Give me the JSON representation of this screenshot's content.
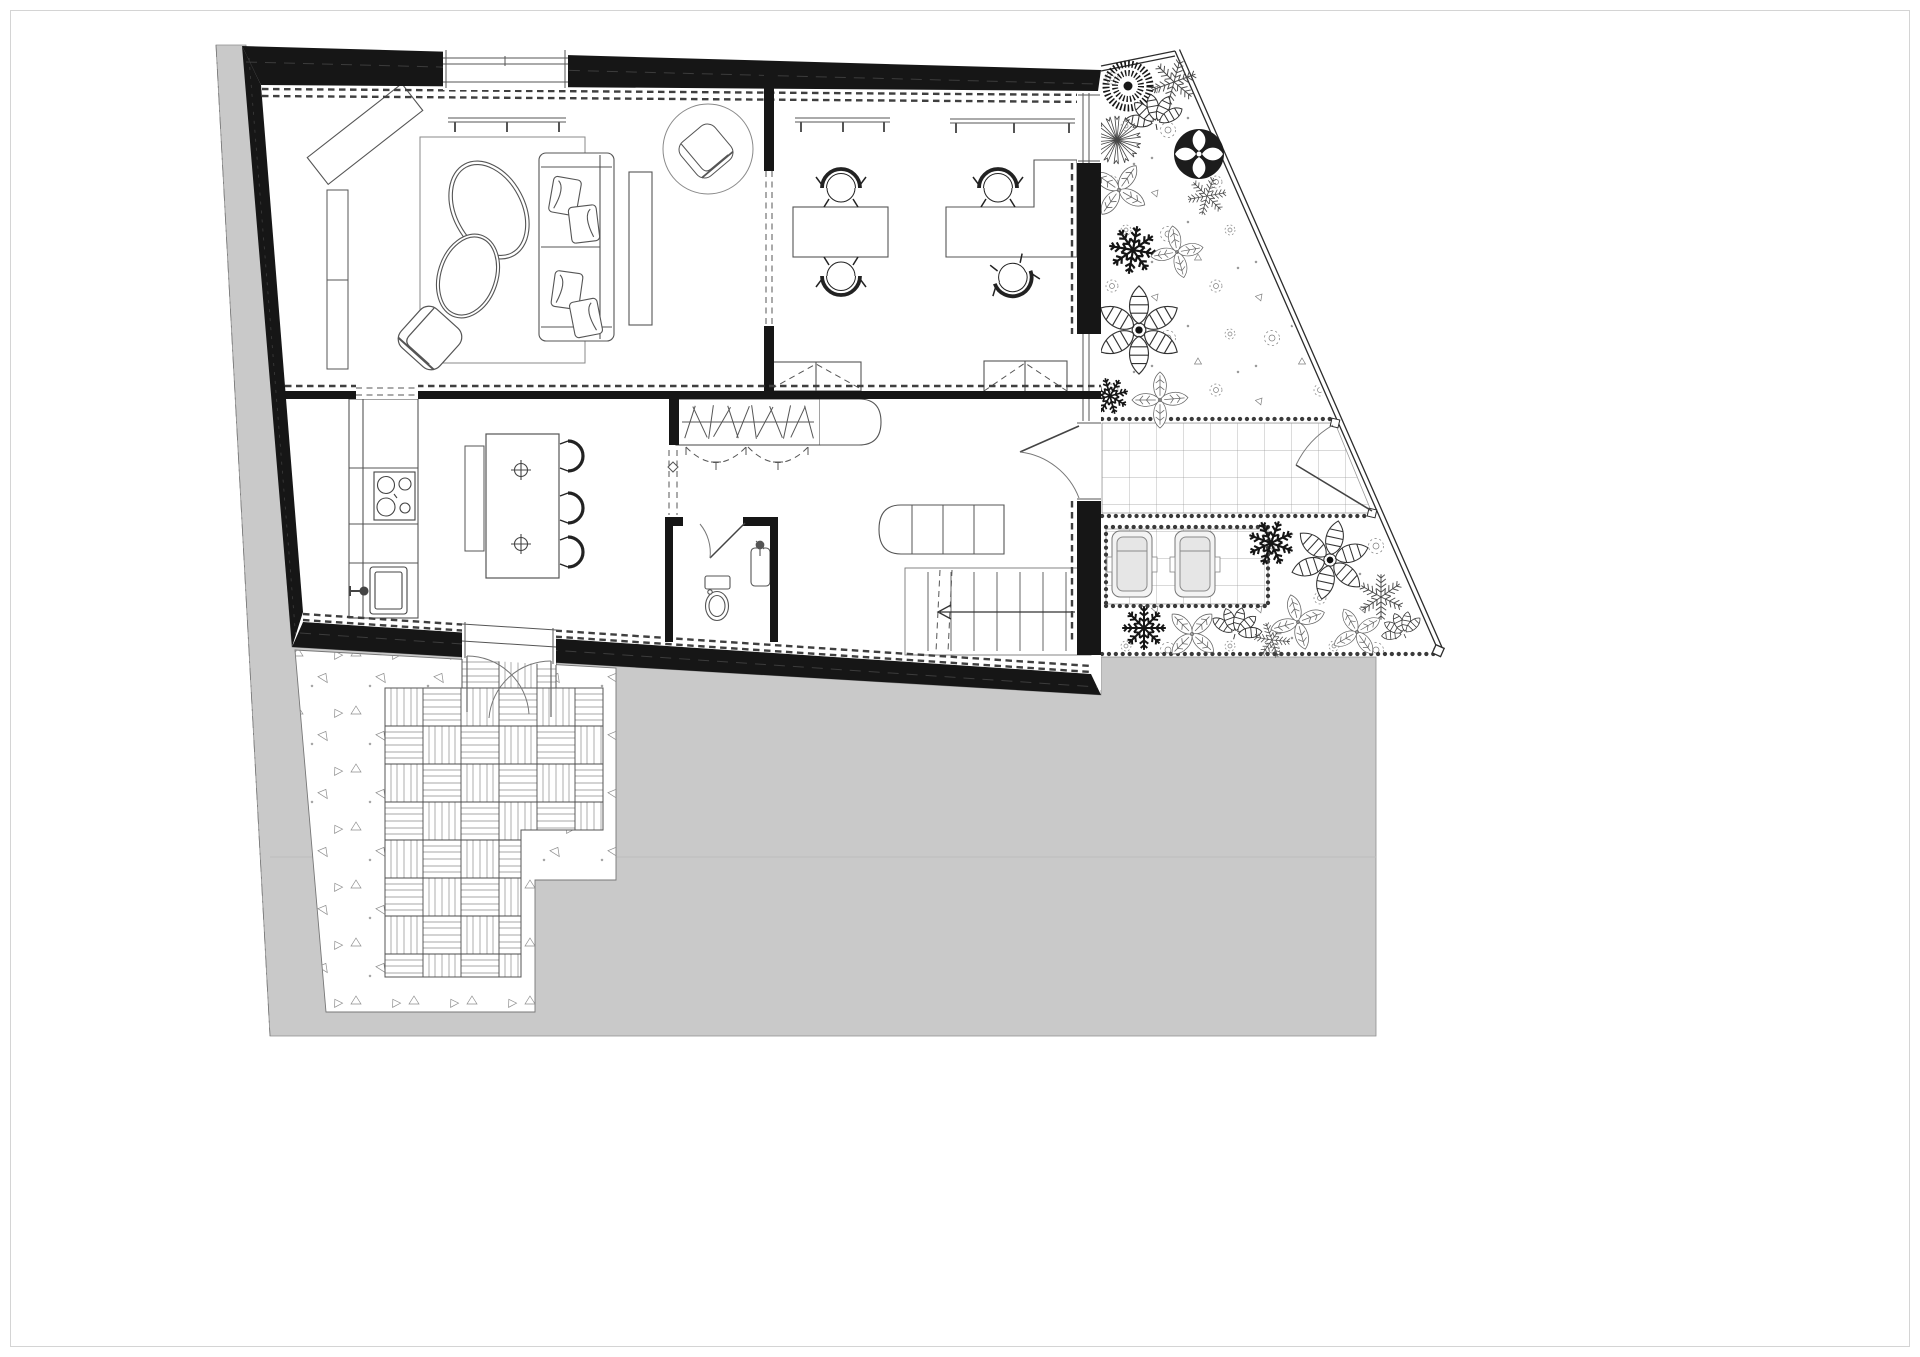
{
  "meta": {
    "drawing_type": "architectural-floor-plan",
    "level": "ground-floor",
    "style": "black-and-white CAD line drawing, no visible text labels",
    "visible_text": ""
  },
  "colors": {
    "paper": "#ffffff",
    "site": "#c9c9c9",
    "wall": "#161616",
    "dark": "#333333",
    "mid": "#666666",
    "light": "#999999",
    "cushion": "#e6e6e6",
    "border": "#d4d4d4"
  },
  "rooms": [
    {
      "name": "living-room",
      "furniture": [
        "area-rug",
        "three-seat-sofa-with-cushions",
        "organic-egg-coffee-table-large",
        "organic-egg-coffee-table-small",
        "lounge-armchair",
        "diagonal-sideboard",
        "wall-bookshelf",
        "media-board",
        "round-rug-reading-nook",
        "reading-armchair",
        "wall-shelf"
      ]
    },
    {
      "name": "home-office",
      "furniture": [
        "desk-1",
        "desk-2-l-shaped",
        "office-chairs-x4",
        "wall-shelves",
        "low-cabinets"
      ]
    },
    {
      "name": "kitchen",
      "furniture": [
        "counter-run",
        "cooktop-4-burners",
        "sink-with-faucet",
        "island-with-two-prep-sinks",
        "bench",
        "bar-stools-x3"
      ]
    },
    {
      "name": "hallway",
      "furniture": [
        "wardrobe-with-hangers",
        "rounded-cabinet",
        "folding-door-arcs"
      ]
    },
    {
      "name": "bathroom",
      "furniture": [
        "toilet",
        "washbasin-with-faucet",
        "inward-swing-door"
      ]
    },
    {
      "name": "staircase",
      "furniture": [
        "treads",
        "down-arrow",
        "bench-at-landing"
      ]
    },
    {
      "name": "entry",
      "furniture": [
        "entry-door-swing"
      ]
    }
  ],
  "outdoor": {
    "zones": [
      "front-garden-bed",
      "tiled-entry-path",
      "garden-gate",
      "patio-with-loungers",
      "side-garden-strip",
      "timber-deck-terrace",
      "gravel-yard",
      "neighboring-plot-gray"
    ],
    "fence": "double-line along street boundary, diagonal on the right side"
  },
  "plants": [
    {
      "t": "bush",
      "x": 1128,
      "y": 86,
      "s": 1,
      "r": 0
    },
    {
      "t": "fern",
      "x": 1174,
      "y": 82,
      "s": 0.95,
      "r": 15
    },
    {
      "t": "banana",
      "x": 1156,
      "y": 124,
      "s": 1,
      "r": -10
    },
    {
      "t": "spiky",
      "x": 1117,
      "y": 140,
      "s": 1,
      "r": 0
    },
    {
      "t": "roundtree",
      "x": 1199,
      "y": 154,
      "s": 1,
      "r": 0
    },
    {
      "t": "fern",
      "x": 1207,
      "y": 196,
      "s": 0.8,
      "r": 80
    },
    {
      "t": "leaf4",
      "x": 1119,
      "y": 190,
      "s": 0.9,
      "r": 20
    },
    {
      "t": "darkstar",
      "x": 1133,
      "y": 250,
      "s": 1.05,
      "r": 10
    },
    {
      "t": "leaf4",
      "x": 1177,
      "y": 252,
      "s": 0.8,
      "r": 65
    },
    {
      "t": "flower6",
      "x": 1139,
      "y": 330,
      "s": 1.05,
      "r": 0
    },
    {
      "t": "darkstar",
      "x": 1110,
      "y": 396,
      "s": 0.8,
      "r": 30
    },
    {
      "t": "leaf4",
      "x": 1160,
      "y": 400,
      "s": 0.85,
      "r": -15
    },
    {
      "t": "darkstar",
      "x": 1144,
      "y": 628,
      "s": 0.95,
      "r": 0
    },
    {
      "t": "leaf4",
      "x": 1192,
      "y": 634,
      "s": 0.85,
      "r": 30
    },
    {
      "t": "banana",
      "x": 1235,
      "y": 634,
      "s": 0.9,
      "r": 15
    },
    {
      "t": "fern",
      "x": 1272,
      "y": 640,
      "s": 0.75,
      "r": -20
    },
    {
      "t": "darkstar",
      "x": 1271,
      "y": 543,
      "s": 1,
      "r": 20
    },
    {
      "t": "flower6",
      "x": 1330,
      "y": 560,
      "s": 0.95,
      "r": 12
    },
    {
      "t": "leaf4",
      "x": 1298,
      "y": 622,
      "s": 0.85,
      "r": -30
    },
    {
      "t": "fern",
      "x": 1381,
      "y": 597,
      "s": 0.95,
      "r": 0
    },
    {
      "t": "leaf4",
      "x": 1357,
      "y": 632,
      "s": 0.8,
      "r": 45
    },
    {
      "t": "banana",
      "x": 1404,
      "y": 634,
      "s": 0.75,
      "r": -25
    }
  ],
  "wardrobe": {
    "rod_y": 422,
    "hanger_xs": [
      690,
      700,
      711,
      722,
      733,
      743,
      754,
      765,
      776,
      787,
      798,
      809
    ],
    "hanger_angles": [
      18,
      -25,
      8,
      30,
      -18,
      22,
      -8,
      28,
      -22,
      12,
      25,
      -15
    ]
  },
  "stairs": {
    "tread_xs": [
      928,
      951,
      974,
      997,
      1020,
      1043,
      1066
    ],
    "tread_y1": 572,
    "tread_y2": 651,
    "arrow": {
      "x1": 1075,
      "x2": 940,
      "y": 612
    }
  },
  "stools": {
    "x": 566,
    "cys": [
      456,
      508,
      552
    ]
  },
  "loungers": {
    "cy": 564,
    "cxs": [
      1132,
      1195
    ]
  },
  "shelves": [
    {
      "x1": 448,
      "x2": 566,
      "y": 118,
      "brackets": [
        455,
        507,
        559
      ]
    },
    {
      "x1": 795,
      "x2": 890,
      "y": 118,
      "brackets": [
        801,
        843,
        884
      ]
    },
    {
      "x1": 950,
      "x2": 1075,
      "y": 119,
      "brackets": [
        956,
        1014,
        1069
      ]
    }
  ]
}
